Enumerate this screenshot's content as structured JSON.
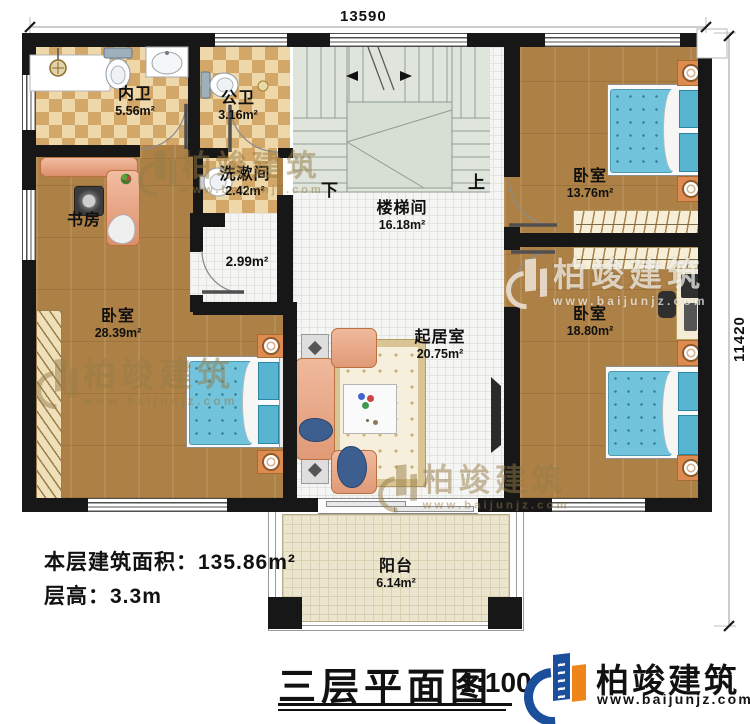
{
  "plan": {
    "dimensions": {
      "width_mm": "13590",
      "height_mm": "11420"
    },
    "rooms": [
      {
        "name": "内卫",
        "area": "5.56m²"
      },
      {
        "name": "公卫",
        "area": "3.16m²"
      },
      {
        "name": "洗漱间",
        "area": "2.42m²"
      },
      {
        "name": "书房"
      },
      {
        "name": "卧室",
        "area": "28.39m²"
      },
      {
        "name": "楼梯间",
        "area": "16.18m²"
      },
      {
        "name": "卧室",
        "area": "13.76m²"
      },
      {
        "name": "卧室",
        "area": "18.80m²"
      },
      {
        "name": "起居室",
        "area": "20.75m²"
      },
      {
        "name": "阳台",
        "area": "6.14m²"
      },
      {
        "area": "2.99m²"
      }
    ],
    "stair_labels": {
      "up": "上",
      "down": "下"
    }
  },
  "info": {
    "floor_area": "本层建筑面积：135.86m²",
    "floor_height": "层高：3.3m"
  },
  "title": {
    "name": "三层平面图",
    "scale": "1:100"
  },
  "brand": {
    "name": "柏竣建筑",
    "website": "www.baijunjz.com",
    "colors": {
      "blue": "#1b4f9c",
      "orange": "#ef8418"
    }
  },
  "watermark": {
    "name": "柏竣建筑",
    "website": "www.baijunjz.com"
  }
}
